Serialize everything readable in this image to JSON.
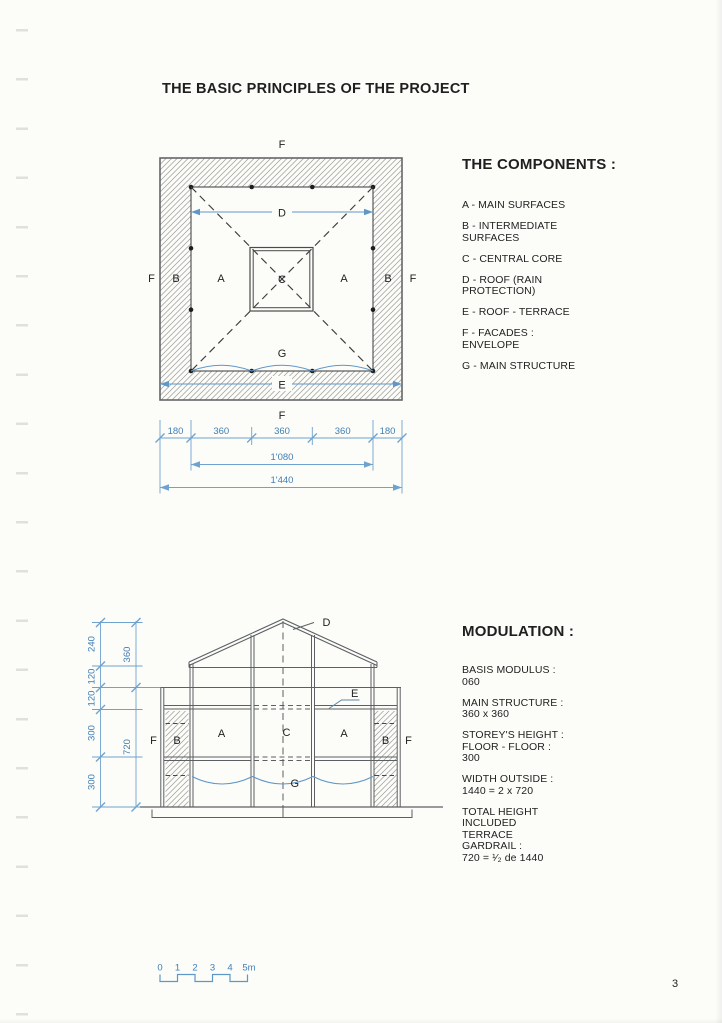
{
  "page": {
    "title": "THE BASIC PRINCIPLES OF THE PROJECT",
    "page_number": "3",
    "accent_blue": "#4a8cc2",
    "ink": "#1f1f1f",
    "paper": "#fcfcf9"
  },
  "components": {
    "heading": "THE COMPONENTS :",
    "items": [
      "A - MAIN SURFACES",
      "B - INTERMEDIATE\nSURFACES",
      "C - CENTRAL CORE",
      "D - ROOF (RAIN\nPROTECTION)",
      "E - ROOF - TERRACE",
      "F - FACADES : ENVELOPE",
      "G - MAIN STRUCTURE"
    ]
  },
  "modulation": {
    "heading": "MODULATION :",
    "items": [
      "BASIS MODULUS :\n060",
      "MAIN STRUCTURE :\n360 x 360",
      "STOREY'S HEIGHT :\nFLOOR - FLOOR :\n300",
      "WIDTH OUTSIDE :\n1440 = 2 x 720",
      "TOTAL HEIGHT\nINCLUDED\nTERRACE\nGARDRAIL :\n720 = ¹⁄₂ de 1440"
    ]
  },
  "plan": {
    "letters": {
      "f": "F",
      "a": "A",
      "b": "B",
      "c": "C",
      "d": "D",
      "e": "E",
      "g": "G"
    },
    "dims": {
      "row_segments": [
        "180",
        "360",
        "360",
        "360",
        "180"
      ],
      "inner_width": "1'080",
      "outer_width": "1'440"
    }
  },
  "section": {
    "letters": {
      "a": "A",
      "b": "B",
      "c": "C",
      "d": "D",
      "e": "E",
      "f": "F",
      "g": "G"
    },
    "dims": {
      "outer_chain": [
        "240",
        "120",
        "120",
        "300",
        "300"
      ],
      "inner_chain": [
        "360",
        "720"
      ]
    }
  },
  "scale_bar": {
    "ticks": [
      "0",
      "1",
      "2",
      "3",
      "4",
      "5m"
    ]
  }
}
